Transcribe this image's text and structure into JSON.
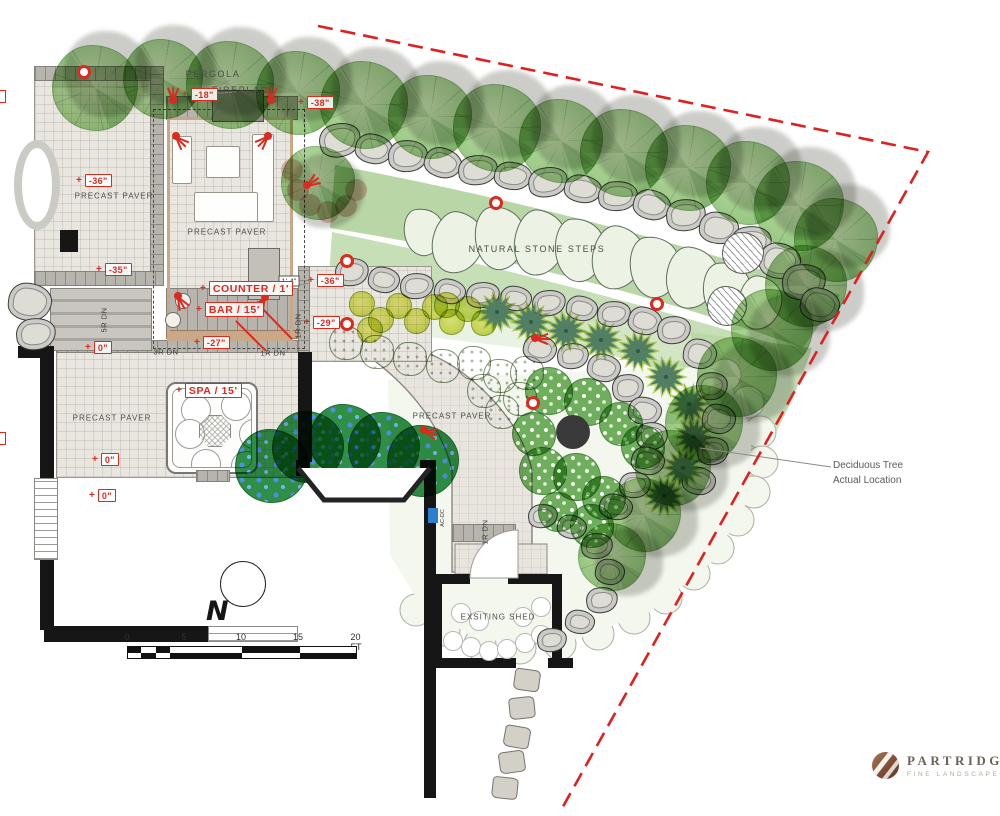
{
  "colors": {
    "accent_red": "#DB2A1E",
    "property_line_red": "#E02020",
    "pergola_tan": "#C8A888",
    "canopy_green": "#A6CF90",
    "paver": "#E9E6E0",
    "wall_black": "#161616"
  },
  "brand": {
    "name": "PARTRIDGE",
    "tagline": "FINE LANDSCAPES"
  },
  "compass": {
    "north_label": "N"
  },
  "scale_bar": {
    "unit_labels": [
      [
        "0",
        127
      ],
      [
        "5",
        184
      ],
      [
        "10",
        241
      ],
      [
        "15",
        298
      ],
      [
        "20 FT",
        356
      ]
    ],
    "x": 127,
    "y": 646,
    "width": 230,
    "height": 13,
    "label_y": 632
  },
  "deciduous_note": {
    "line1": "Deciduous Tree",
    "line2": "Actual Location",
    "x": 833,
    "y": 458,
    "leader": [
      831,
      467,
      700,
      448
    ]
  },
  "plan": {
    "labels": [
      {
        "t": "PERGOLA",
        "x": 213,
        "y": 74,
        "cls": "lbl"
      },
      {
        "t": "FIREPLACE",
        "x": 244,
        "y": 90,
        "cls": "lbl"
      },
      {
        "t": "PRECAST PAVER",
        "x": 114,
        "y": 196,
        "cls": "lbl sm"
      },
      {
        "t": "PRECAST PAVER",
        "x": 227,
        "y": 232,
        "cls": "lbl sm"
      },
      {
        "t": "NATURAL STONE STEPS",
        "x": 537,
        "y": 249,
        "cls": "lbl"
      },
      {
        "t": "PRECAST PAVER",
        "x": 452,
        "y": 416,
        "cls": "lbl sm"
      },
      {
        "t": "PRECAST PAVER",
        "x": 112,
        "y": 418,
        "cls": "lbl sm"
      },
      {
        "t": "EXSITING SHED",
        "x": 498,
        "y": 617,
        "cls": "lbl sm"
      },
      {
        "t": "5R DN",
        "x": 104,
        "y": 320,
        "cls": "tiny v"
      },
      {
        "t": "3R DN",
        "x": 166,
        "y": 352,
        "cls": "tiny"
      },
      {
        "t": "1R DN",
        "x": 273,
        "y": 353,
        "cls": "tiny"
      },
      {
        "t": "1R DN",
        "x": 298,
        "y": 326,
        "cls": "tiny v"
      },
      {
        "t": "1R DN",
        "x": 485,
        "y": 532,
        "cls": "tiny v"
      },
      {
        "t": "AC-DC",
        "x": 443,
        "y": 518,
        "cls": "micro v"
      },
      {
        "t": "1'-4\"",
        "x": 289,
        "y": 281,
        "cls": "dim"
      }
    ],
    "callouts": [
      {
        "t": "-18\"",
        "x": 182,
        "y": 96
      },
      {
        "t": "-38\"",
        "x": 298,
        "y": 104
      },
      {
        "t": "-36\"",
        "x": 76,
        "y": 182
      },
      {
        "t": "-35\"",
        "x": 96,
        "y": 271
      },
      {
        "t": "-36\"",
        "x": 308,
        "y": 282
      },
      {
        "t": "-29\"",
        "x": 304,
        "y": 324
      },
      {
        "t": "-27\"",
        "x": 194,
        "y": 344
      },
      {
        "t": "0\"",
        "x": 85,
        "y": 349
      },
      {
        "t": "0\"",
        "x": 92,
        "y": 461
      },
      {
        "t": "0\"",
        "x": 89,
        "y": 497
      },
      {
        "t": "COUNTER / 1'",
        "x": 200,
        "y": 289,
        "big": true
      },
      {
        "t": "BAR / 15'",
        "x": 196,
        "y": 310,
        "big": true
      },
      {
        "t": "SPA / 15'",
        "x": 176,
        "y": 391,
        "big": true
      }
    ],
    "edge_markers": [
      [
        0,
        90
      ],
      [
        0,
        432
      ]
    ],
    "terraces": [
      {
        "x": 34,
        "y": 66,
        "w": 130,
        "h": 220,
        "cls": "pav"
      },
      {
        "x": 167,
        "y": 117,
        "w": 126,
        "h": 224,
        "cls": "pav"
      },
      {
        "x": 56,
        "y": 352,
        "w": 246,
        "h": 126,
        "cls": "pav"
      },
      {
        "x": 298,
        "y": 266,
        "w": 134,
        "h": 96,
        "cls": "pav"
      }
    ],
    "bands": [
      {
        "x": 34,
        "y": 66,
        "w": 130,
        "h": 15,
        "cls": "band"
      },
      {
        "x": 150,
        "y": 66,
        "w": 14,
        "h": 220,
        "cls": "bandv"
      },
      {
        "x": 34,
        "y": 271,
        "w": 130,
        "h": 15,
        "cls": "band"
      },
      {
        "x": 166,
        "y": 96,
        "w": 132,
        "h": 24,
        "cls": "band"
      },
      {
        "x": 166,
        "y": 288,
        "w": 132,
        "h": 44,
        "cls": "band"
      },
      {
        "x": 166,
        "y": 330,
        "w": 132,
        "h": 9,
        "cls": "tan"
      },
      {
        "x": 56,
        "y": 340,
        "w": 246,
        "h": 13,
        "cls": "band"
      },
      {
        "x": 298,
        "y": 266,
        "w": 12,
        "h": 96,
        "cls": "bandv"
      },
      {
        "x": 452,
        "y": 524,
        "w": 64,
        "h": 18,
        "cls": "band"
      }
    ],
    "stairs": [
      {
        "x": 50,
        "y": 288,
        "w": 102,
        "h": 63
      }
    ],
    "walls": [
      [
        18,
        346,
        34,
        12
      ],
      [
        60,
        230,
        18,
        22
      ],
      [
        40,
        346,
        14,
        132
      ],
      [
        40,
        560,
        14,
        70
      ],
      [
        44,
        626,
        164,
        16
      ],
      [
        298,
        352,
        14,
        110
      ],
      [
        296,
        460,
        14,
        16
      ],
      [
        420,
        460,
        16,
        16
      ],
      [
        424,
        476,
        12,
        184
      ],
      [
        424,
        658,
        12,
        140
      ],
      [
        432,
        574,
        10,
        94
      ],
      [
        552,
        574,
        10,
        94
      ],
      [
        432,
        574,
        38,
        10
      ],
      [
        508,
        574,
        54,
        10
      ],
      [
        432,
        658,
        84,
        10
      ],
      [
        548,
        658,
        25,
        10
      ]
    ],
    "windows": [
      [
        34,
        478,
        24,
        82
      ],
      [
        208,
        626,
        90,
        16
      ]
    ],
    "fireplace": {
      "x": 212,
      "y": 90,
      "w": 52,
      "h": 32
    },
    "pergola_frame": {
      "x": 167,
      "y": 117,
      "w": 126,
      "h": 224
    },
    "pergola_dashed": {
      "x": 153,
      "y": 109,
      "w": 152,
      "h": 240
    },
    "furniture": [
      [
        172,
        136,
        20,
        48
      ],
      [
        206,
        146,
        34,
        32
      ],
      [
        252,
        134,
        22,
        88
      ],
      [
        194,
        192,
        64,
        30
      ]
    ],
    "pergola_door": {
      "x": 248,
      "y": 248,
      "w": 32,
      "h": 52
    },
    "stools": [
      [
        183,
        301
      ],
      [
        173,
        320
      ]
    ],
    "grill": {
      "x": 236,
      "y": 302,
      "w": 18,
      "h": 11
    },
    "ac_unit": {
      "x": 428,
      "y": 508,
      "w": 10,
      "h": 15
    },
    "spa": {
      "x": 166,
      "y": 382,
      "w": 92,
      "h": 92
    },
    "ellipse": {
      "x": 14,
      "y": 140,
      "w": 46,
      "h": 90
    },
    "boulders": [
      [
        340,
        140,
        42,
        34,
        -15
      ],
      [
        374,
        149,
        38,
        30,
        10
      ],
      [
        408,
        156,
        40,
        32,
        -5
      ],
      [
        443,
        163,
        38,
        30,
        15
      ],
      [
        478,
        170,
        40,
        30,
        -8
      ],
      [
        513,
        176,
        38,
        28,
        5
      ],
      [
        548,
        182,
        40,
        30,
        -12
      ],
      [
        583,
        189,
        38,
        28,
        8
      ],
      [
        618,
        196,
        40,
        30,
        -5
      ],
      [
        652,
        205,
        38,
        30,
        12
      ],
      [
        686,
        215,
        40,
        32,
        -8
      ],
      [
        719,
        228,
        40,
        32,
        6
      ],
      [
        751,
        243,
        42,
        34,
        -10
      ],
      [
        780,
        261,
        42,
        36,
        8
      ],
      [
        804,
        282,
        44,
        36,
        -6
      ],
      [
        820,
        305,
        40,
        34,
        10
      ],
      [
        352,
        272,
        34,
        28,
        -10
      ],
      [
        384,
        280,
        32,
        26,
        8
      ],
      [
        417,
        286,
        34,
        26,
        -6
      ],
      [
        450,
        291,
        32,
        25,
        10
      ],
      [
        483,
        295,
        34,
        26,
        -8
      ],
      [
        516,
        298,
        32,
        25,
        6
      ],
      [
        549,
        303,
        34,
        26,
        -10
      ],
      [
        582,
        308,
        32,
        25,
        8
      ],
      [
        614,
        314,
        34,
        26,
        -6
      ],
      [
        645,
        321,
        34,
        28,
        10
      ],
      [
        674,
        330,
        34,
        28,
        -8
      ],
      [
        540,
        349,
        34,
        28,
        12
      ],
      [
        573,
        356,
        32,
        26,
        -8
      ],
      [
        604,
        368,
        34,
        28,
        8
      ],
      [
        628,
        388,
        32,
        28,
        -10
      ],
      [
        645,
        411,
        34,
        28,
        6
      ],
      [
        652,
        436,
        32,
        28,
        -8
      ],
      [
        648,
        461,
        34,
        28,
        10
      ],
      [
        635,
        485,
        32,
        26,
        -6
      ],
      [
        616,
        507,
        34,
        26,
        8
      ],
      [
        700,
        354,
        34,
        30,
        8
      ],
      [
        712,
        386,
        32,
        28,
        -8
      ],
      [
        719,
        419,
        34,
        30,
        6
      ],
      [
        713,
        451,
        32,
        28,
        -10
      ],
      [
        699,
        481,
        34,
        28,
        8
      ],
      [
        543,
        516,
        30,
        24,
        -8
      ],
      [
        572,
        527,
        30,
        24,
        10
      ],
      [
        597,
        546,
        32,
        26,
        -6
      ],
      [
        610,
        572,
        30,
        26,
        8
      ],
      [
        602,
        600,
        32,
        26,
        -10
      ],
      [
        580,
        622,
        30,
        24,
        6
      ],
      [
        552,
        640,
        30,
        24,
        -8
      ],
      [
        30,
        302,
        44,
        38,
        5
      ],
      [
        36,
        334,
        40,
        32,
        -8
      ]
    ],
    "stones": [
      [
        424,
        232,
        40,
        48,
        -10
      ],
      [
        458,
        243,
        52,
        62,
        12
      ],
      [
        500,
        238,
        50,
        64,
        -6
      ],
      [
        540,
        243,
        52,
        66,
        8
      ],
      [
        580,
        250,
        50,
        64,
        -5
      ],
      [
        618,
        258,
        52,
        64,
        10
      ],
      [
        655,
        267,
        50,
        62,
        -8
      ],
      [
        692,
        278,
        52,
        62,
        6
      ],
      [
        727,
        291,
        48,
        58,
        -6
      ],
      [
        760,
        303,
        44,
        54,
        8
      ]
    ],
    "yellow": [
      [
        362,
        304
      ],
      [
        381,
        320
      ],
      [
        399,
        306
      ],
      [
        417,
        321
      ],
      [
        435,
        307
      ],
      [
        452,
        322
      ],
      [
        468,
        309
      ],
      [
        484,
        323
      ],
      [
        447,
        305
      ],
      [
        370,
        330
      ]
    ],
    "fluffy": [
      [
        346,
        343
      ],
      [
        377,
        352
      ],
      [
        410,
        359
      ],
      [
        443,
        366
      ],
      [
        474,
        363
      ],
      [
        500,
        376
      ],
      [
        527,
        373
      ],
      [
        484,
        391
      ],
      [
        520,
        399
      ],
      [
        502,
        412
      ]
    ],
    "stars": [
      [
        497,
        312
      ],
      [
        531,
        322
      ],
      [
        566,
        331
      ],
      [
        601,
        340
      ],
      [
        638,
        351
      ],
      [
        666,
        377
      ],
      [
        689,
        404
      ],
      [
        694,
        437
      ],
      [
        683,
        468
      ],
      [
        664,
        496
      ]
    ],
    "blue": [
      [
        272,
        466,
        37
      ],
      [
        308,
        447,
        36
      ],
      [
        345,
        440,
        36
      ],
      [
        384,
        448,
        36
      ],
      [
        423,
        461,
        36
      ]
    ],
    "whitedot": [
      [
        549,
        391,
        24
      ],
      [
        588,
        402,
        24
      ],
      [
        621,
        424,
        22
      ],
      [
        643,
        447,
        22
      ],
      [
        534,
        434,
        22
      ],
      [
        543,
        471,
        24
      ],
      [
        577,
        477,
        24
      ],
      [
        604,
        498,
        22
      ],
      [
        592,
        526,
        22
      ],
      [
        558,
        512,
        20
      ]
    ],
    "dark_circle": {
      "x": 573,
      "y": 432,
      "r": 17
    },
    "hatched": [
      [
        743,
        253,
        21
      ],
      [
        727,
        306,
        20
      ]
    ],
    "steppers": [
      [
        527,
        680,
        8
      ],
      [
        522,
        708,
        -6
      ],
      [
        517,
        737,
        10
      ],
      [
        512,
        762,
        -8
      ],
      [
        505,
        788,
        6
      ]
    ],
    "trees_top": [
      [
        95,
        88,
        86
      ],
      [
        163,
        79,
        80
      ],
      [
        230,
        85,
        88
      ],
      [
        298,
        93,
        84
      ],
      [
        364,
        105,
        88
      ],
      [
        430,
        117,
        84
      ],
      [
        497,
        128,
        88
      ],
      [
        561,
        141,
        84
      ],
      [
        624,
        153,
        88
      ],
      [
        688,
        168,
        86
      ],
      [
        748,
        183,
        84
      ],
      [
        799,
        206,
        90
      ],
      [
        836,
        240,
        84
      ]
    ],
    "trees_right": [
      [
        806,
        286,
        82
      ],
      [
        772,
        330,
        82
      ],
      [
        737,
        377,
        80
      ],
      [
        704,
        424,
        78
      ],
      [
        673,
        468,
        76
      ],
      [
        644,
        515,
        74
      ],
      [
        612,
        557,
        68
      ]
    ],
    "pink_tree": {
      "x": 318,
      "y": 183,
      "s": 74
    },
    "targets": [
      [
        84,
        72
      ],
      [
        347,
        261
      ],
      [
        496,
        203
      ],
      [
        657,
        304
      ],
      [
        533,
        403
      ],
      [
        347,
        324
      ]
    ],
    "sprays": [
      [
        173,
        100,
        -90
      ],
      [
        271,
        100,
        -90
      ],
      [
        176,
        136,
        45
      ],
      [
        268,
        136,
        135
      ],
      [
        178,
        296,
        60
      ],
      [
        265,
        297,
        120
      ],
      [
        307,
        185,
        -35
      ],
      [
        535,
        338,
        0
      ],
      [
        424,
        430,
        15
      ]
    ],
    "redlines": [
      [
        258,
        303,
        34,
        35
      ],
      [
        236,
        320,
        30,
        30
      ]
    ],
    "property_line": [
      [
        318,
        26
      ],
      [
        928,
        152
      ],
      [
        560,
        812
      ]
    ],
    "bay_window": [
      [
        298,
        468
      ],
      [
        324,
        500
      ],
      [
        404,
        500
      ],
      [
        430,
        468
      ]
    ],
    "leaders": [
      [
        230,
        80,
        196,
        96
      ],
      [
        236,
        92,
        205,
        94
      ],
      [
        289,
        287,
        310,
        283
      ]
    ],
    "cloud_arc": [
      [
        725,
        375
      ],
      [
        748,
        402
      ],
      [
        760,
        432
      ],
      [
        762,
        462
      ],
      [
        754,
        492
      ],
      [
        738,
        520
      ],
      [
        718,
        548
      ],
      [
        694,
        574
      ],
      [
        666,
        598
      ],
      [
        634,
        618
      ],
      [
        598,
        634
      ],
      [
        560,
        644
      ],
      [
        520,
        648
      ],
      [
        480,
        644
      ],
      [
        444,
        630
      ],
      [
        416,
        610
      ]
    ],
    "shed_scallops": [
      [
        452,
        640
      ],
      [
        470,
        646
      ],
      [
        488,
        650
      ],
      [
        506,
        648
      ],
      [
        524,
        642
      ],
      [
        540,
        634
      ],
      [
        460,
        612
      ],
      [
        478,
        620
      ],
      [
        522,
        616
      ],
      [
        540,
        606
      ]
    ],
    "pink_fringe": [
      [
        292,
        170
      ],
      [
        298,
        190
      ],
      [
        310,
        205
      ],
      [
        328,
        212
      ],
      [
        346,
        206
      ],
      [
        356,
        190
      ]
    ]
  }
}
